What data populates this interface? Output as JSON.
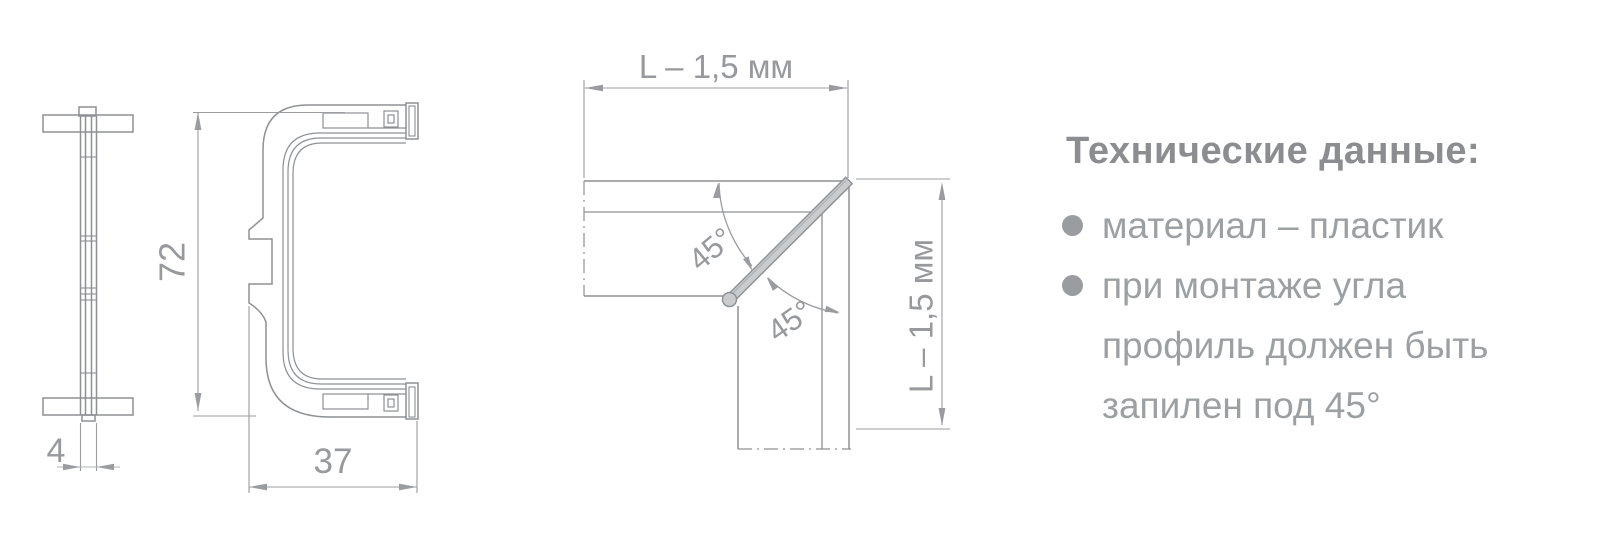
{
  "side_view": {
    "width_label": "4"
  },
  "section_view": {
    "height_label": "72",
    "width_label": "37"
  },
  "corner_view": {
    "length_label_top": "L – 1,5 мм",
    "length_label_right": "L – 1,5 мм",
    "angle_label_upper": "45°",
    "angle_label_lower": "45°"
  },
  "tech": {
    "title": "Технические данные:",
    "bullets": [
      {
        "lines": [
          "материал – пластик"
        ]
      },
      {
        "lines": [
          "при монтаже угла",
          "профиль должен быть",
          "запилен под 45°"
        ]
      }
    ]
  },
  "colors": {
    "drawing_line": "#8d9094",
    "dimension": "#97999c",
    "miter_fill": "#c9cbcd",
    "body_text": "#9da0a2",
    "title_text": "#8b8d90"
  }
}
